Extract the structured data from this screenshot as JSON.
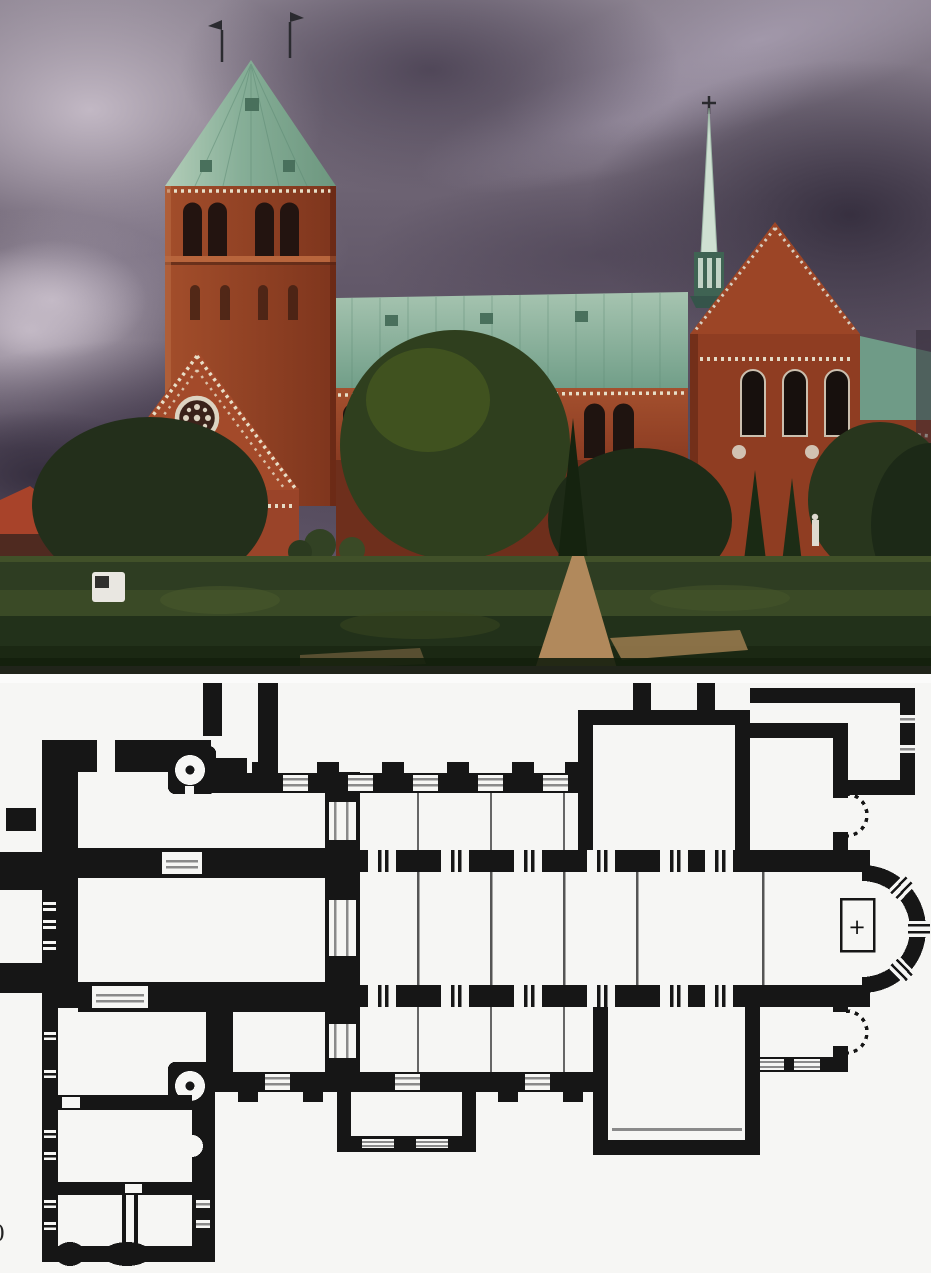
{
  "page": {
    "background": "#ffffff"
  },
  "marginalia": {
    "fragment": "0"
  },
  "photo": {
    "alt": "Brick Romanesque cathedral seen across formal gardens under a dark stormy violet sky; massive west tower with green copper pyramid roof and twin weathervanes, long green nave roof, slender crossing spire, gabled transept with three arched windows, white ornamental brick bands and rose window on the west gable",
    "palette": {
      "sky_base": "#6b6171",
      "sky_light": "#c6bcc8",
      "sky_dark": "#342d3d",
      "copper_roof": "#86ae97",
      "brick": "#9a4427",
      "brick_shadow": "#7b331d",
      "ornament": "#e8dfc8",
      "foliage_dark": "#1d2a15",
      "foliage": "#33421f",
      "hedge": "#2e3d22",
      "path": "#b1895c",
      "van": "#e9e7e1",
      "spire": "#cfe0d2"
    }
  },
  "plan": {
    "alt": "Ground plan: westwork block with stair turrets, six-bay aisled nave, north and south transepts, choir with semicircular apse containing the altar, flanking chapels with dashed apse outlines, and a southwest wing of vaulted rooms",
    "altar_cross": "+",
    "ink": "#161616",
    "paper": "#f6f6f4",
    "window_line": "#8a8a8a"
  }
}
